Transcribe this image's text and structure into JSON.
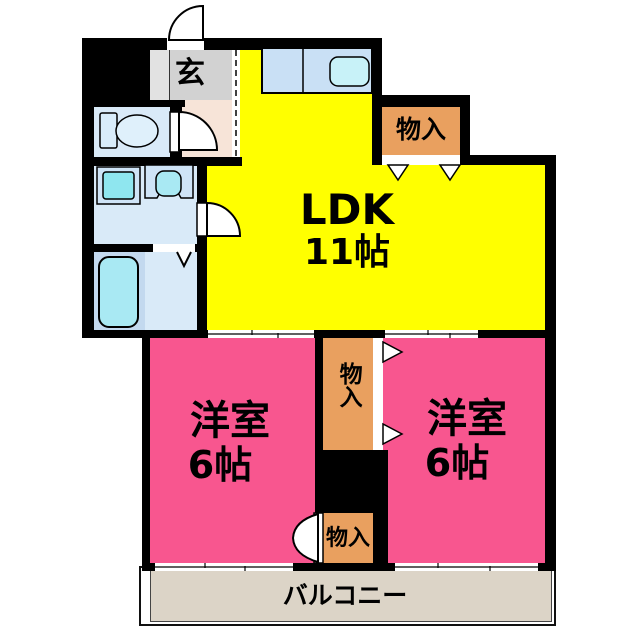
{
  "plan_type": "apartment-floor-plan",
  "colors": {
    "wall": "#000000",
    "ldk": "#ffff00",
    "bedroom": "#f8568f",
    "closet": "#e9a05f",
    "genkan": "#d2d2d2",
    "genkan_light": "#e2e2e2",
    "hall": "#f7e4d8",
    "wet_room": "#d9eaf8",
    "bath_left": "#c3d9ef",
    "fixture_teal": "#a9e9f3",
    "washer_teal": "#8fe6ef",
    "sink_teal": "#c8f2f8",
    "counter_blue": "#c9e0f5",
    "balcony": "#dcd4c7"
  },
  "rooms": {
    "genkan": {
      "label": "玄"
    },
    "ldk": {
      "label": "LDK",
      "size": "11帖"
    },
    "closet_top": {
      "label": "物入"
    },
    "closet_mid": {
      "label": "物入"
    },
    "closet_bottom": {
      "label": "物入"
    },
    "bedroom_left": {
      "label": "洋室",
      "size": "6帖"
    },
    "bedroom_right": {
      "label": "洋室",
      "size": "6帖"
    },
    "balcony": {
      "label": "バルコニー"
    }
  }
}
